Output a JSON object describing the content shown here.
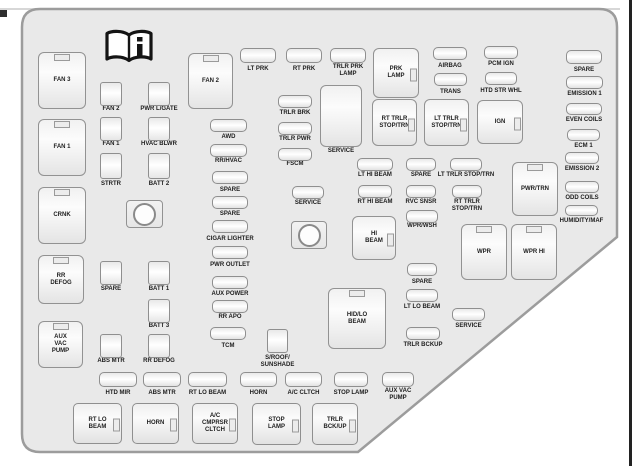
{
  "diagram": {
    "name": "Engine Compartment Fuse Block",
    "icon": "owners-manual-book-info-icon",
    "colors": {
      "panel_fill": "#e9e9e9",
      "panel_border": "#9c9c9c",
      "fuse_border": "#8f8f8f",
      "label_text": "#1d1d1d",
      "page_rule": "#222222"
    }
  },
  "items": [
    {
      "n": "box-fan-3",
      "t": "vbox",
      "l": "FAN 3",
      "x": 38,
      "y": 52,
      "w": 48,
      "h": 57,
      "tab": "top"
    },
    {
      "n": "box-fan-1",
      "t": "vbox",
      "l": "FAN 1",
      "x": 38,
      "y": 119,
      "w": 48,
      "h": 57,
      "tab": "top"
    },
    {
      "n": "box-crnk",
      "t": "vbox",
      "l": "CRNK",
      "x": 38,
      "y": 187,
      "w": 48,
      "h": 57,
      "tab": "top"
    },
    {
      "n": "box-rr-defog",
      "t": "vbox",
      "l": "RR\nDEFOG",
      "x": 38,
      "y": 255,
      "w": 46,
      "h": 49,
      "tab": "top"
    },
    {
      "n": "box-aux-vac-pump",
      "t": "vbox",
      "l": "AUX\nVAC\nPUMP",
      "x": 38,
      "y": 321,
      "w": 45,
      "h": 47,
      "tab": "top"
    },
    {
      "n": "box-fan-2",
      "t": "vbox",
      "l": "FAN 2",
      "x": 188,
      "y": 53,
      "w": 45,
      "h": 56,
      "tab": "top"
    },
    {
      "n": "box-prk-lamp",
      "t": "vbox",
      "l": "PRK\nLAMP",
      "x": 373,
      "y": 48,
      "w": 46,
      "h": 50,
      "tab": "right"
    },
    {
      "n": "box-rt-trlr-stop-trn",
      "t": "vbox",
      "l": "RT TRLR\nSTOP/TRN",
      "x": 372,
      "y": 99,
      "w": 45,
      "h": 47,
      "tab": "right"
    },
    {
      "n": "box-lt-trlr-stop-trn",
      "t": "vbox",
      "l": "LT TRLR\nSTOP/TRN",
      "x": 424,
      "y": 99,
      "w": 45,
      "h": 47,
      "tab": "right"
    },
    {
      "n": "box-ign",
      "t": "vbox",
      "l": "IGN",
      "x": 477,
      "y": 100,
      "w": 46,
      "h": 44,
      "tab": "right"
    },
    {
      "n": "box-service-tall",
      "t": "vbox",
      "l": "SERVICE",
      "x": 320,
      "y": 85,
      "w": 42,
      "h": 62,
      "lp": "below",
      "ly": 148
    },
    {
      "n": "box-hi-beam",
      "t": "vbox",
      "l": "HI\nBEAM",
      "x": 352,
      "y": 216,
      "w": 44,
      "h": 44,
      "tab": "right"
    },
    {
      "n": "box-pwr-trn",
      "t": "vbox",
      "l": "PWR/TRN",
      "x": 512,
      "y": 162,
      "w": 46,
      "h": 54,
      "tab": "top"
    },
    {
      "n": "box-wpr",
      "t": "vbox",
      "l": "WPR",
      "x": 461,
      "y": 224,
      "w": 46,
      "h": 56,
      "tab": "top"
    },
    {
      "n": "box-wpr-hi",
      "t": "vbox",
      "l": "WPR HI",
      "x": 511,
      "y": 224,
      "w": 46,
      "h": 56,
      "tab": "top"
    },
    {
      "n": "box-hid-lo-beam",
      "t": "vbox",
      "l": "HID/LO\nBEAM",
      "x": 328,
      "y": 288,
      "w": 58,
      "h": 61,
      "tab": "top"
    },
    {
      "n": "box-rt-lo-beam",
      "t": "bbox",
      "l": "RT LO\nBEAM",
      "x": 73,
      "y": 403,
      "w": 49,
      "h": 41,
      "tab": "right"
    },
    {
      "n": "box-horn",
      "t": "bbox",
      "l": "HORN",
      "x": 132,
      "y": 403,
      "w": 47,
      "h": 41,
      "tab": "right"
    },
    {
      "n": "box-ac-cmprsr-cltch",
      "t": "bbox",
      "l": "A/C\nCMPRSR\nCLTCH",
      "x": 192,
      "y": 403,
      "w": 46,
      "h": 41,
      "tab": "right"
    },
    {
      "n": "box-stop-lamp",
      "t": "bbox",
      "l": "STOP\nLAMP",
      "x": 252,
      "y": 403,
      "w": 49,
      "h": 42,
      "tab": "right"
    },
    {
      "n": "box-trlr-bck-up",
      "t": "bbox",
      "l": "TRLR\nBCK/UP",
      "x": 312,
      "y": 403,
      "w": 46,
      "h": 42,
      "tab": "right"
    },
    {
      "n": "fuse-fan-2",
      "t": "sq",
      "l": "FAN 2",
      "x": 100,
      "y": 82,
      "w": 22,
      "h": 24,
      "ly": 106
    },
    {
      "n": "fuse-fan-1",
      "t": "sq",
      "l": "FAN 1",
      "x": 100,
      "y": 117,
      "w": 22,
      "h": 24,
      "ly": 141
    },
    {
      "n": "fuse-strtr",
      "t": "sq",
      "l": "STRTR",
      "x": 100,
      "y": 153,
      "w": 22,
      "h": 26,
      "ly": 181
    },
    {
      "n": "fuse-spare-1",
      "t": "sq",
      "l": "SPARE",
      "x": 100,
      "y": 261,
      "w": 22,
      "h": 24,
      "ly": 286
    },
    {
      "n": "fuse-abs-mtr-1",
      "t": "sq",
      "l": "ABS MTR",
      "x": 100,
      "y": 334,
      "w": 22,
      "h": 24,
      "ly": 358
    },
    {
      "n": "fuse-pwr-lgate",
      "t": "sq",
      "l": "PWR L/GATE",
      "x": 148,
      "y": 82,
      "w": 22,
      "h": 24,
      "ly": 106
    },
    {
      "n": "fuse-hvac-blwr",
      "t": "sq",
      "l": "HVAC BLWR",
      "x": 148,
      "y": 117,
      "w": 22,
      "h": 24,
      "ly": 141
    },
    {
      "n": "fuse-batt-2",
      "t": "sq",
      "l": "BATT 2",
      "x": 148,
      "y": 153,
      "w": 22,
      "h": 26,
      "ly": 181
    },
    {
      "n": "fuse-batt-1",
      "t": "sq",
      "l": "BATT 1",
      "x": 148,
      "y": 261,
      "w": 22,
      "h": 24,
      "ly": 286
    },
    {
      "n": "fuse-batt-3",
      "t": "sq",
      "l": "BATT 3",
      "x": 148,
      "y": 299,
      "w": 22,
      "h": 24,
      "ly": 323
    },
    {
      "n": "fuse-rr-defog",
      "t": "sq",
      "l": "RR DEFOG",
      "x": 148,
      "y": 334,
      "w": 22,
      "h": 24,
      "ly": 358
    },
    {
      "n": "fuse-sroof-sunshade",
      "t": "sq",
      "l": "S/ROOF/\nSUNSHADE",
      "x": 267,
      "y": 329,
      "w": 21,
      "h": 24,
      "ly": 355
    },
    {
      "n": "relay-1",
      "t": "relay",
      "x": 126,
      "y": 200,
      "w": 37,
      "h": 28
    },
    {
      "n": "relay-2",
      "t": "relay",
      "x": 291,
      "y": 221,
      "w": 36,
      "h": 28
    },
    {
      "n": "fuse-lt-prk",
      "t": "pill",
      "l": "LT PRK",
      "x": 240,
      "y": 48,
      "w": 36,
      "h": 15,
      "ly": 66
    },
    {
      "n": "fuse-rt-prk",
      "t": "pill",
      "l": "RT PRK",
      "x": 286,
      "y": 48,
      "w": 36,
      "h": 15,
      "ly": 66
    },
    {
      "n": "fuse-trlr-prk-lamp",
      "t": "pill",
      "l": "TRLR PRK\nLAMP",
      "x": 330,
      "y": 48,
      "w": 36,
      "h": 15,
      "ly": 64
    },
    {
      "n": "fuse-airbag",
      "t": "pill",
      "l": "AIRBAG",
      "x": 433,
      "y": 47,
      "w": 34,
      "h": 13,
      "ly": 63
    },
    {
      "n": "fuse-pcm-ign",
      "t": "pill",
      "l": "PCM IGN",
      "x": 484,
      "y": 46,
      "w": 34,
      "h": 13,
      "ly": 61
    },
    {
      "n": "fuse-trans",
      "t": "pill",
      "l": "TRANS",
      "x": 434,
      "y": 73,
      "w": 33,
      "h": 13,
      "ly": 89
    },
    {
      "n": "fuse-htd-str-whl",
      "t": "pill",
      "l": "HTD STR WHL",
      "x": 485,
      "y": 72,
      "w": 32,
      "h": 13,
      "ly": 88
    },
    {
      "n": "fuse-spare-2",
      "t": "pill",
      "l": "SPARE",
      "x": 566,
      "y": 50,
      "w": 36,
      "h": 14,
      "ly": 67
    },
    {
      "n": "fuse-emission-1",
      "t": "pill",
      "l": "EMISSION 1",
      "x": 566,
      "y": 76,
      "w": 37,
      "h": 13,
      "ly": 91
    },
    {
      "n": "fuse-even-coils",
      "t": "pill",
      "l": "EVEN COILS",
      "x": 566,
      "y": 103,
      "w": 36,
      "h": 12,
      "ly": 117
    },
    {
      "n": "fuse-ecm-1",
      "t": "pill",
      "l": "ECM 1",
      "x": 567,
      "y": 129,
      "w": 33,
      "h": 12,
      "ly": 143
    },
    {
      "n": "fuse-emission-2",
      "t": "pill",
      "l": "EMISSION 2",
      "x": 565,
      "y": 152,
      "w": 34,
      "h": 12,
      "ly": 166
    },
    {
      "n": "fuse-odd-coils",
      "t": "pill",
      "l": "ODD COILS",
      "x": 565,
      "y": 181,
      "w": 34,
      "h": 12,
      "ly": 195
    },
    {
      "n": "fuse-humidity-maf",
      "t": "pill",
      "l": "HUMIDITY/MAF",
      "x": 565,
      "y": 205,
      "w": 33,
      "h": 11,
      "ly": 218
    },
    {
      "n": "fuse-trlr-brk",
      "t": "pill",
      "l": "TRLR BRK",
      "x": 278,
      "y": 95,
      "w": 34,
      "h": 13,
      "ly": 110
    },
    {
      "n": "fuse-trlr-pwr",
      "t": "pill",
      "l": "TRLR PWR",
      "x": 278,
      "y": 122,
      "w": 34,
      "h": 13,
      "ly": 136
    },
    {
      "n": "fuse-fscm",
      "t": "pill",
      "l": "FSCM",
      "x": 278,
      "y": 148,
      "w": 34,
      "h": 13,
      "ly": 161
    },
    {
      "n": "fuse-service-1",
      "t": "pill",
      "l": "SERVICE",
      "x": 292,
      "y": 186,
      "w": 32,
      "h": 13,
      "ly": 200
    },
    {
      "n": "fuse-awd",
      "t": "pill",
      "l": "AWD",
      "x": 210,
      "y": 119,
      "w": 37,
      "h": 13,
      "ly": 134
    },
    {
      "n": "fuse-rr-hvac",
      "t": "pill",
      "l": "RR/HVAC",
      "x": 210,
      "y": 144,
      "w": 37,
      "h": 13,
      "ly": 158
    },
    {
      "n": "fuse-spare-3",
      "t": "pill",
      "l": "SPARE",
      "x": 212,
      "y": 171,
      "w": 36,
      "h": 13,
      "ly": 187
    },
    {
      "n": "fuse-spare-4",
      "t": "pill",
      "l": "SPARE",
      "x": 212,
      "y": 196,
      "w": 36,
      "h": 13,
      "ly": 211
    },
    {
      "n": "fuse-cigar-lighter",
      "t": "pill",
      "l": "CIGAR LIGHTER",
      "x": 212,
      "y": 220,
      "w": 36,
      "h": 13,
      "ly": 236
    },
    {
      "n": "fuse-pwr-outlet",
      "t": "pill",
      "l": "PWR OUTLET",
      "x": 212,
      "y": 246,
      "w": 36,
      "h": 13,
      "ly": 262
    },
    {
      "n": "fuse-aux-power",
      "t": "pill",
      "l": "AUX POWER",
      "x": 212,
      "y": 276,
      "w": 36,
      "h": 13,
      "ly": 291
    },
    {
      "n": "fuse-rr-apo",
      "t": "pill",
      "l": "RR APO",
      "x": 212,
      "y": 300,
      "w": 36,
      "h": 13,
      "ly": 314
    },
    {
      "n": "fuse-tcm",
      "t": "pill",
      "l": "TCM",
      "x": 210,
      "y": 327,
      "w": 36,
      "h": 13,
      "ly": 343
    },
    {
      "n": "fuse-lt-hi-beam",
      "t": "pill",
      "l": "LT HI BEAM",
      "x": 357,
      "y": 158,
      "w": 36,
      "h": 13,
      "ly": 172
    },
    {
      "n": "fuse-spare-5",
      "t": "pill",
      "l": "SPARE",
      "x": 406,
      "y": 158,
      "w": 30,
      "h": 13,
      "ly": 172
    },
    {
      "n": "fuse-lt-trlr-stop-trn",
      "t": "pill",
      "l": "LT TRLR STOP/TRN",
      "x": 450,
      "y": 158,
      "w": 32,
      "h": 13,
      "ly": 172
    },
    {
      "n": "fuse-rt-hi-beam",
      "t": "pill",
      "l": "RT HI BEAM",
      "x": 358,
      "y": 185,
      "w": 34,
      "h": 13,
      "ly": 199
    },
    {
      "n": "fuse-rvc-snsr",
      "t": "pill",
      "l": "RVC SNSR",
      "x": 406,
      "y": 185,
      "w": 30,
      "h": 13,
      "ly": 199
    },
    {
      "n": "fuse-rt-trlr-stop-trn",
      "t": "pill",
      "l": "RT TRLR\nSTOP/TRN",
      "x": 452,
      "y": 185,
      "w": 30,
      "h": 13,
      "ly": 199
    },
    {
      "n": "fuse-wpr-wsh",
      "t": "pill",
      "l": "WPR/WSH",
      "x": 406,
      "y": 210,
      "w": 32,
      "h": 13,
      "ly": 223
    },
    {
      "n": "fuse-spare-6",
      "t": "pill",
      "l": "SPARE",
      "x": 407,
      "y": 263,
      "w": 30,
      "h": 13,
      "ly": 279
    },
    {
      "n": "fuse-lt-lo-beam",
      "t": "pill",
      "l": "LT LO BEAM",
      "x": 406,
      "y": 289,
      "w": 32,
      "h": 13,
      "ly": 304
    },
    {
      "n": "fuse-service-2",
      "t": "pill",
      "l": "SERVICE",
      "x": 452,
      "y": 308,
      "w": 33,
      "h": 13,
      "ly": 323
    },
    {
      "n": "fuse-trlr-bckup",
      "t": "pill",
      "l": "TRLR BCKUP",
      "x": 406,
      "y": 327,
      "w": 34,
      "h": 13,
      "ly": 342
    },
    {
      "n": "fuse-htd-mir",
      "t": "pill",
      "l": "HTD MIR",
      "x": 99,
      "y": 372,
      "w": 38,
      "h": 15,
      "ly": 390
    },
    {
      "n": "fuse-abs-mtr-2",
      "t": "pill",
      "l": "ABS MTR",
      "x": 143,
      "y": 372,
      "w": 38,
      "h": 15,
      "ly": 390
    },
    {
      "n": "fuse-rt-lo-beam",
      "t": "pill",
      "l": "RT LO BEAM",
      "x": 188,
      "y": 372,
      "w": 39,
      "h": 15,
      "ly": 390
    },
    {
      "n": "fuse-horn",
      "t": "pill",
      "l": "HORN",
      "x": 240,
      "y": 372,
      "w": 37,
      "h": 15,
      "ly": 390
    },
    {
      "n": "fuse-ac-cltch",
      "t": "pill",
      "l": "A/C CLTCH",
      "x": 285,
      "y": 372,
      "w": 37,
      "h": 15,
      "ly": 390
    },
    {
      "n": "fuse-stop-lamp",
      "t": "pill",
      "l": "STOP LAMP",
      "x": 334,
      "y": 372,
      "w": 34,
      "h": 15,
      "ly": 390
    },
    {
      "n": "fuse-aux-vac-pump",
      "t": "pill",
      "l": "AUX VAC\nPUMP",
      "x": 382,
      "y": 372,
      "w": 32,
      "h": 15,
      "ly": 388
    }
  ]
}
